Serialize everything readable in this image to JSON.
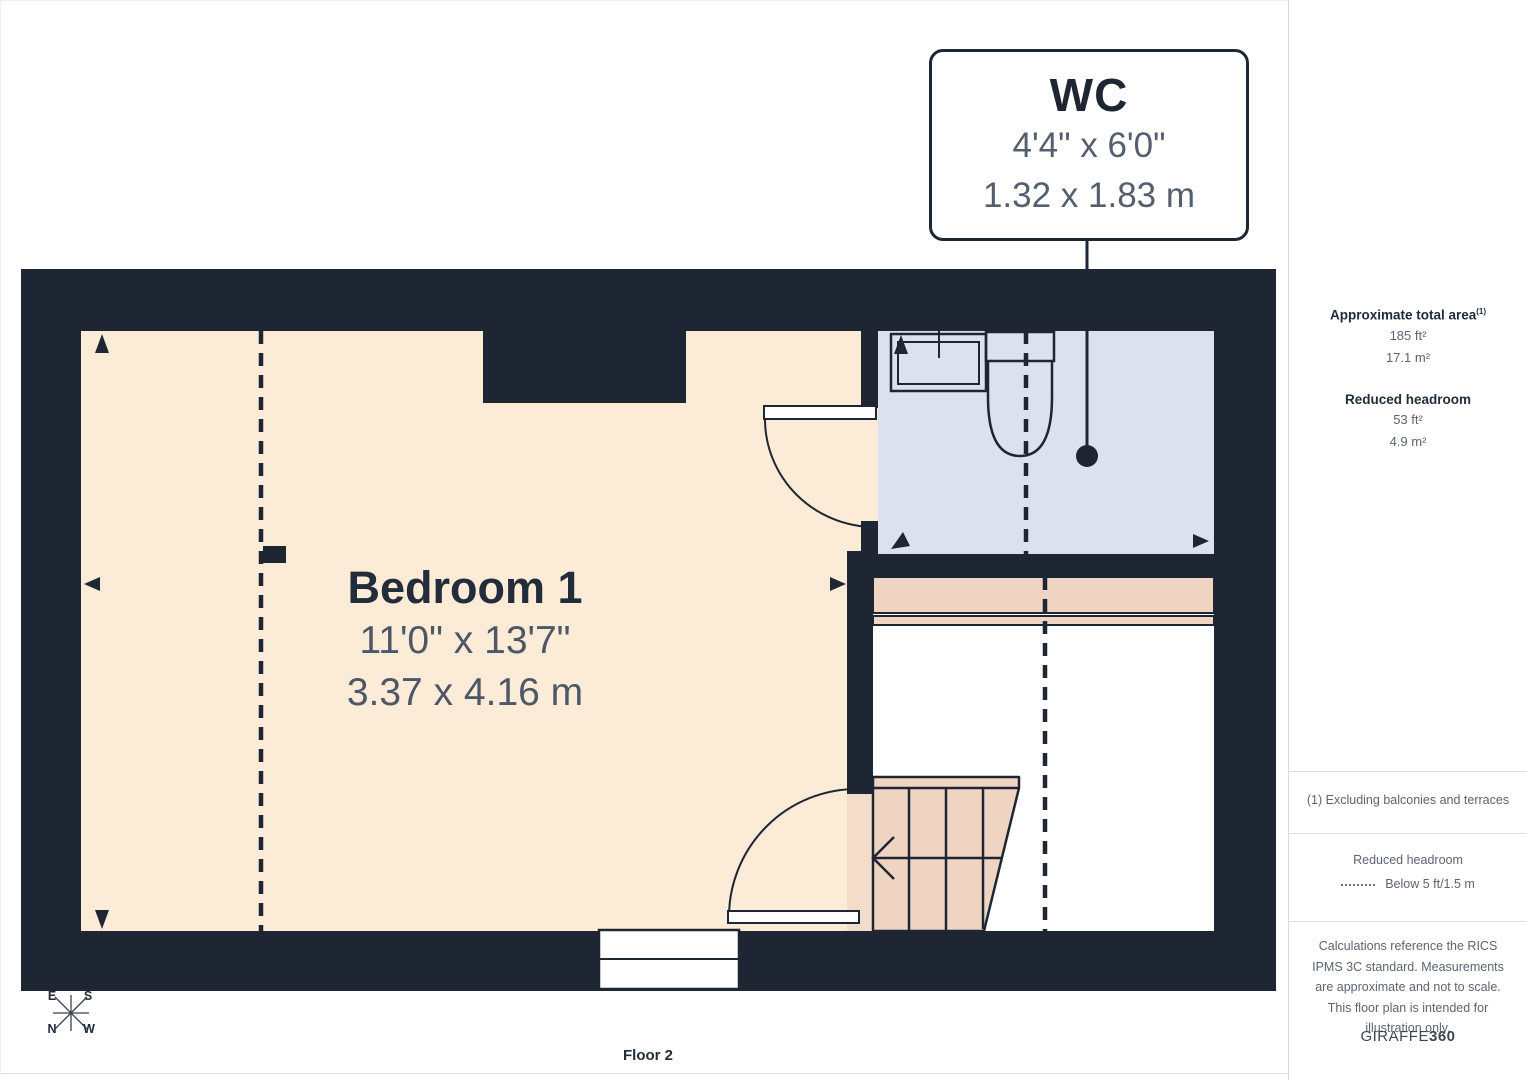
{
  "floorplan": {
    "callout": {
      "room": "WC",
      "imperial": "4'4\" x 6'0\"",
      "metric": "1.32 x 1.83 m"
    },
    "bedroom": {
      "name": "Bedroom 1",
      "imperial": "11'0\" x 13'7\"",
      "metric": "3.37 x 4.16 m"
    },
    "floor_label": "Floor 2",
    "compass": {
      "top_left": "E",
      "top_right": "S",
      "bottom_left": "N",
      "bottom_right": "W"
    }
  },
  "sidebar": {
    "total_area_heading": "Approximate total area",
    "total_area_footnote_marker": "(1)",
    "total_area_imperial": "185 ft²",
    "total_area_metric": "17.1 m²",
    "reduced_headroom_heading": "Reduced headroom",
    "reduced_headroom_imperial": "53 ft²",
    "reduced_headroom_metric": "4.9 m²",
    "footnote": "(1) Excluding balconies and terraces",
    "legend_title": "Reduced headroom",
    "legend_item": "Below 5 ft/1.5 m",
    "disclaimer": "Calculations reference the RICS IPMS 3C standard. Measurements are approximate and not to scale. This floor plan is intended for illustration only.",
    "brand_name": "GIRAFFE",
    "brand_suffix": "360"
  },
  "colors": {
    "wall": "#1e2634",
    "bedroom_fill": "#fcebd7",
    "wc_fill": "#dbe1ed",
    "stairs_fill": "#f0d4c2",
    "doorway_fill": "#f3dcc9",
    "text_dark": "#222c3a",
    "text_gray": "#5b6472"
  }
}
